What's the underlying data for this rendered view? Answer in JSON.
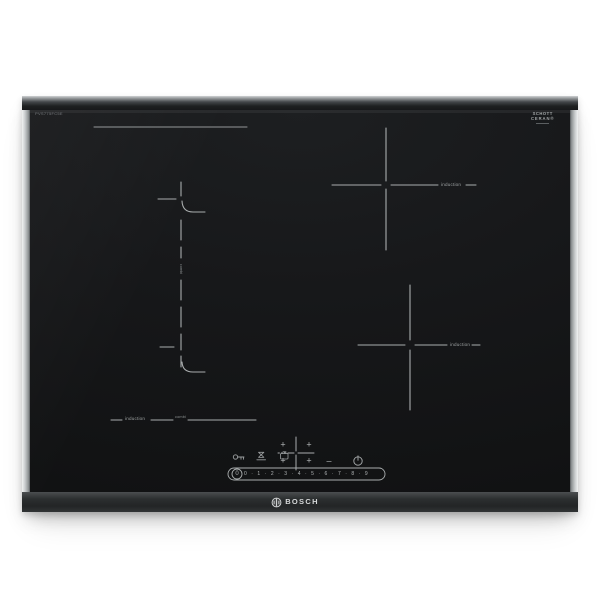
{
  "hob": {
    "brand": "BOSCH",
    "model_text": "PVS775FC5E",
    "glass_logo": {
      "line1": "SCHOTT",
      "line2": "CERAN®"
    },
    "labels": {
      "right_top_zone": "induction",
      "right_bottom_zone": "induction",
      "left_zone_induction": "induction",
      "left_zone_combi": "combi",
      "divider_text": "combi"
    },
    "controls": {
      "icons": [
        {
          "name": "key-icon",
          "meaning": "child lock touch key"
        },
        {
          "name": "egg-timer-icon",
          "meaning": "short-term timer touch key"
        },
        {
          "name": "kitchen-timer-icon",
          "meaning": "cooking timer touch key"
        },
        {
          "name": "zone-selector-cross",
          "meaning": "4-zone selection keys"
        },
        {
          "name": "power-icon",
          "meaning": "main on/off touch key"
        }
      ],
      "plus": "+",
      "minus": "–",
      "slider": {
        "off_label": "0",
        "levels": [
          "0",
          "1",
          "2",
          "3",
          "4",
          "5",
          "6",
          "7",
          "8",
          "9"
        ],
        "display": "0 · 1 · 2 · 3 · 4 · 5 · 6 · 7 · 8 · 9"
      }
    },
    "colors": {
      "background": "#ffffff",
      "glass": "#17181a",
      "markings": "#a9adae",
      "trim": "#d7d9da",
      "front_edge": "#2c2f30"
    }
  }
}
